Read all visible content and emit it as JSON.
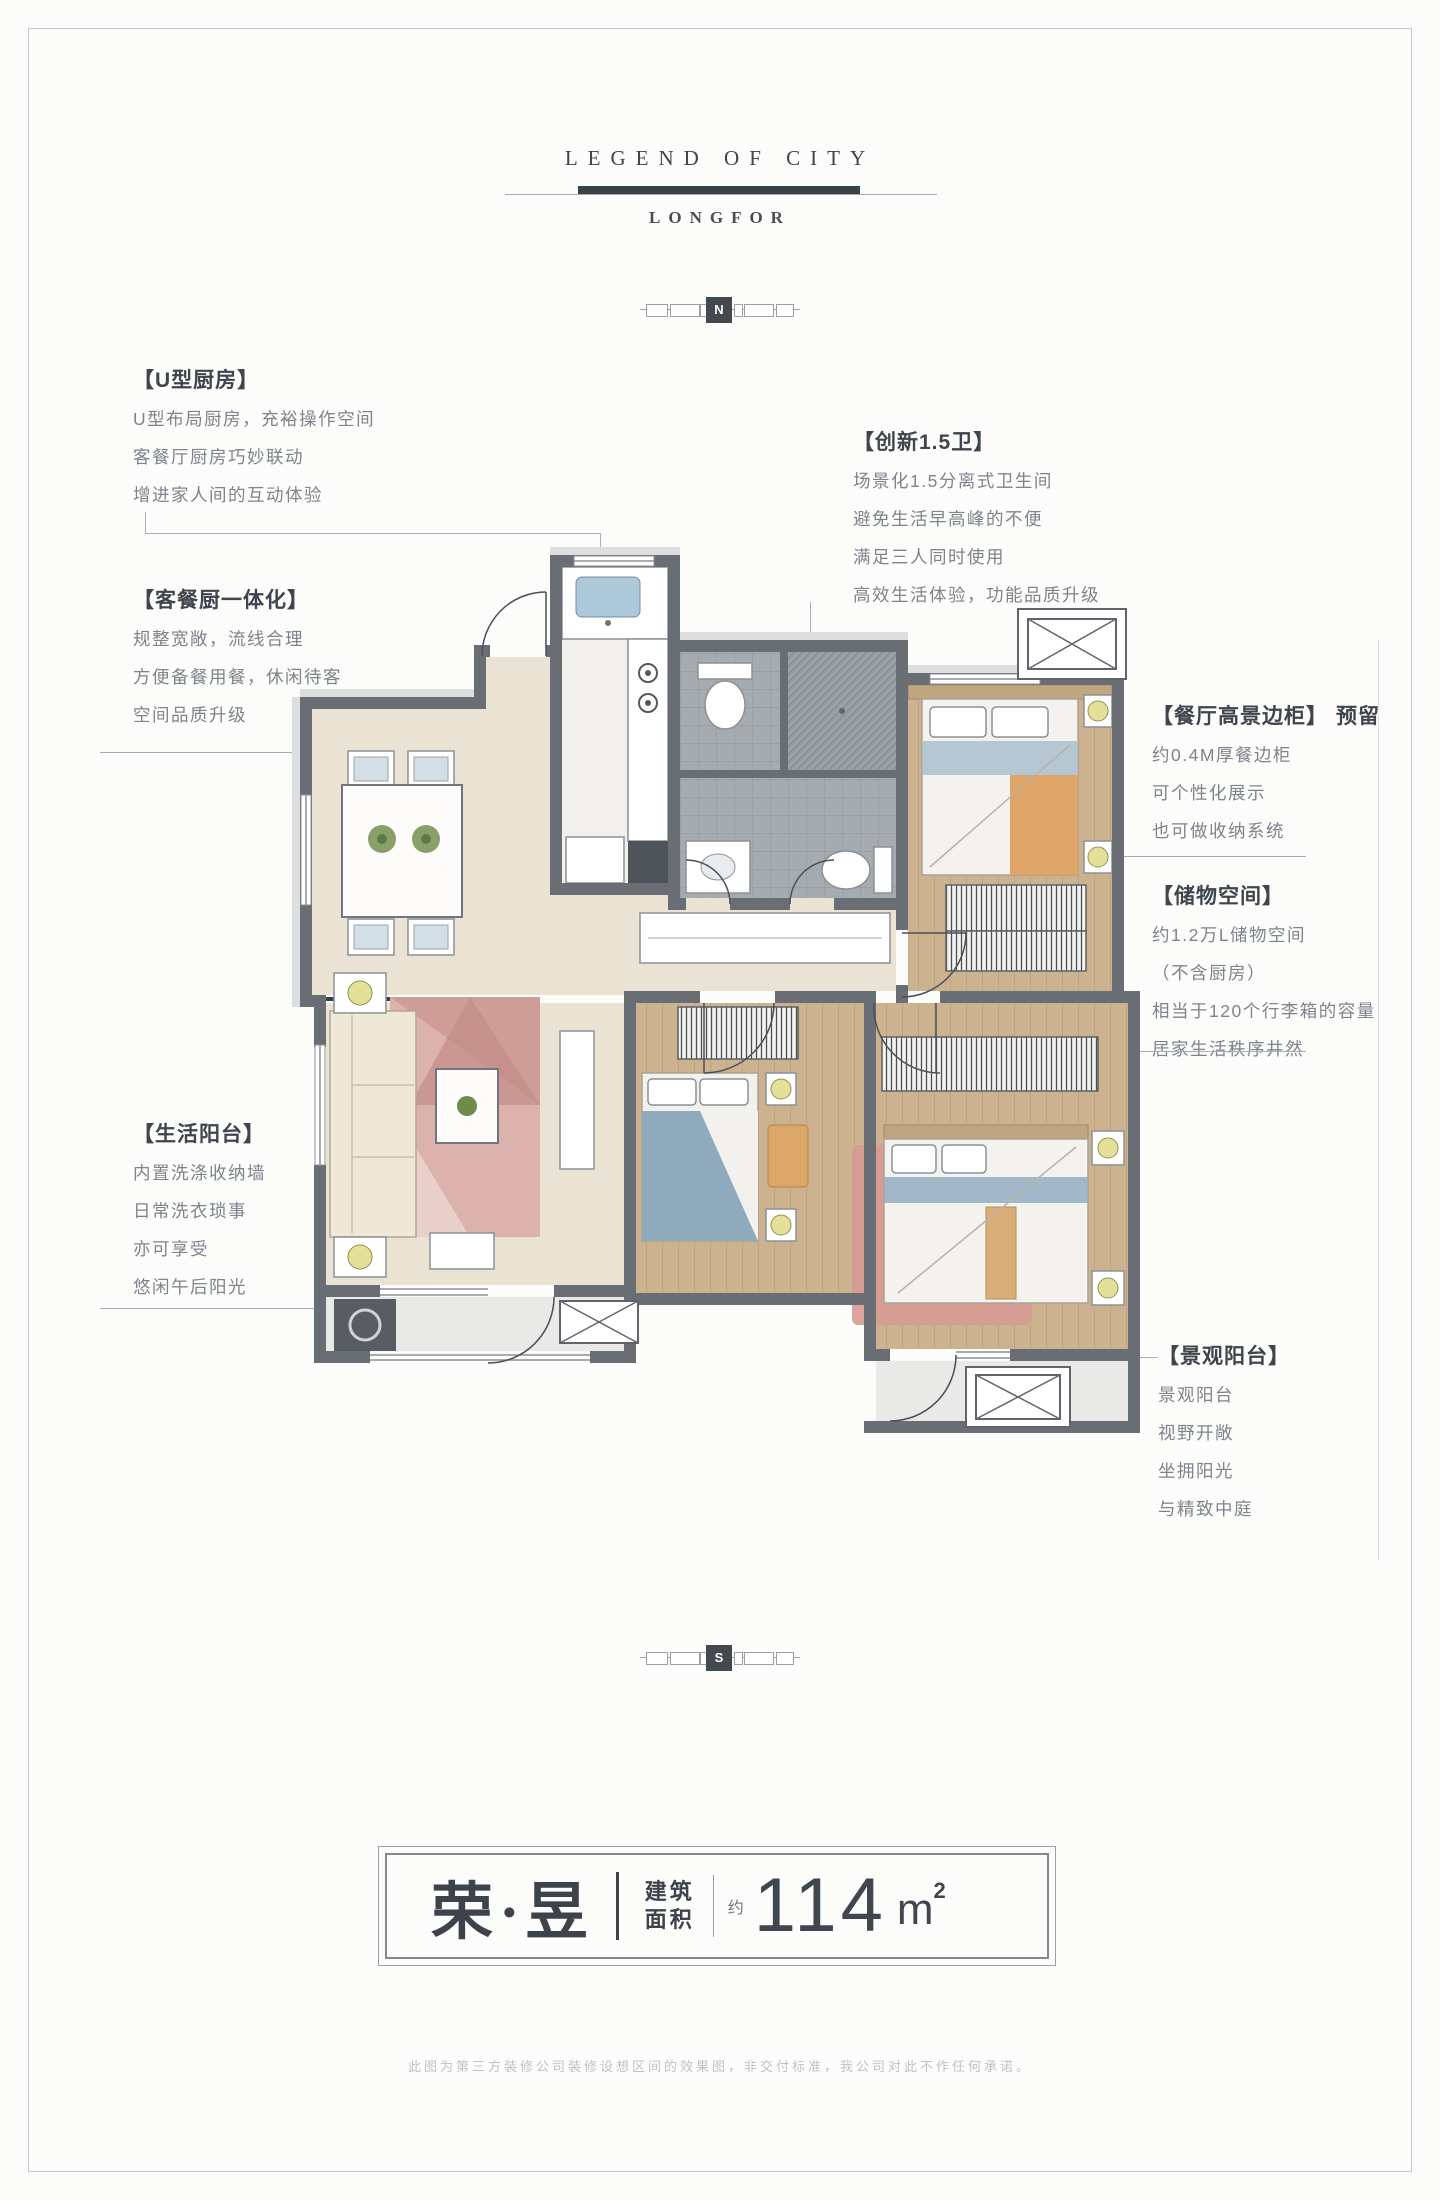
{
  "palette": {
    "page_bg": "#fcfcfb",
    "frame": "#c6c8ca",
    "heading": "#3e454c",
    "body_text": "#7d848c",
    "brand_bar": "#3a4147",
    "wall": "#686e74",
    "floor_beige": "#eae3d4",
    "floor_wood": "#ccb28e",
    "floor_tile": "#a6abaf",
    "floor_balcony": "#e9e9e7",
    "rug_pink": "#d9aca7",
    "bed_blue": "#8fa9bd",
    "blanket_orange": "#dfa468",
    "accent_yellow": "#e4e09a",
    "plant_green": "#6f8a4d"
  },
  "header": {
    "brand_top": "LEGEND OF CITY",
    "brand_bottom": "LONGFOR"
  },
  "compass": {
    "north": "N",
    "south": "S"
  },
  "callouts": {
    "u_kitchen": {
      "title": "【U型厨房】",
      "lines": [
        "U型布局厨房，充裕操作空间",
        "客餐厅厨房巧妙联动",
        "增进家人间的互动体验"
      ]
    },
    "integrated": {
      "title": "【客餐厨一体化】",
      "lines": [
        "规整宽敞，流线合理",
        "方便备餐用餐，休闲待客",
        "空间品质升级"
      ]
    },
    "life_balcony": {
      "title": "【生活阳台】",
      "lines": [
        "内置洗涤收纳墙",
        "日常洗衣琐事",
        "亦可享受",
        "悠闲午后阳光"
      ]
    },
    "bath": {
      "title": "【创新1.5卫】",
      "lines": [
        "场景化1.5分离式卫生间",
        "避免生活早高峰的不便",
        "满足三人同时使用",
        "高效生活体验，功能品质升级"
      ]
    },
    "sideboard": {
      "title": "【餐厅高景边柜】",
      "tag": "预留",
      "lines": [
        "约0.4M厚餐边柜",
        "可个性化展示",
        "也可做收纳系统"
      ]
    },
    "storage": {
      "title": "【储物空间】",
      "lines": [
        "约1.2万L储物空间",
        "（不含厨房）",
        "相当于120个行李箱的容量",
        "居家生活秩序井然"
      ]
    },
    "view_balcony": {
      "title": "【景观阳台】",
      "lines": [
        "景观阳台",
        "视野开敞",
        "坐拥阳光",
        "与精致中庭"
      ]
    }
  },
  "title_card": {
    "name": "荣·昱",
    "area_label_top": "建筑",
    "area_label_bottom": "面积",
    "approx": "约",
    "value": "114",
    "unit": "m",
    "unit_sup": "2"
  },
  "footer": {
    "disclaimer": "此图为第三方装修公司装修设想区间的效果图，非交付标准，我公司对此不作任何承诺。"
  }
}
